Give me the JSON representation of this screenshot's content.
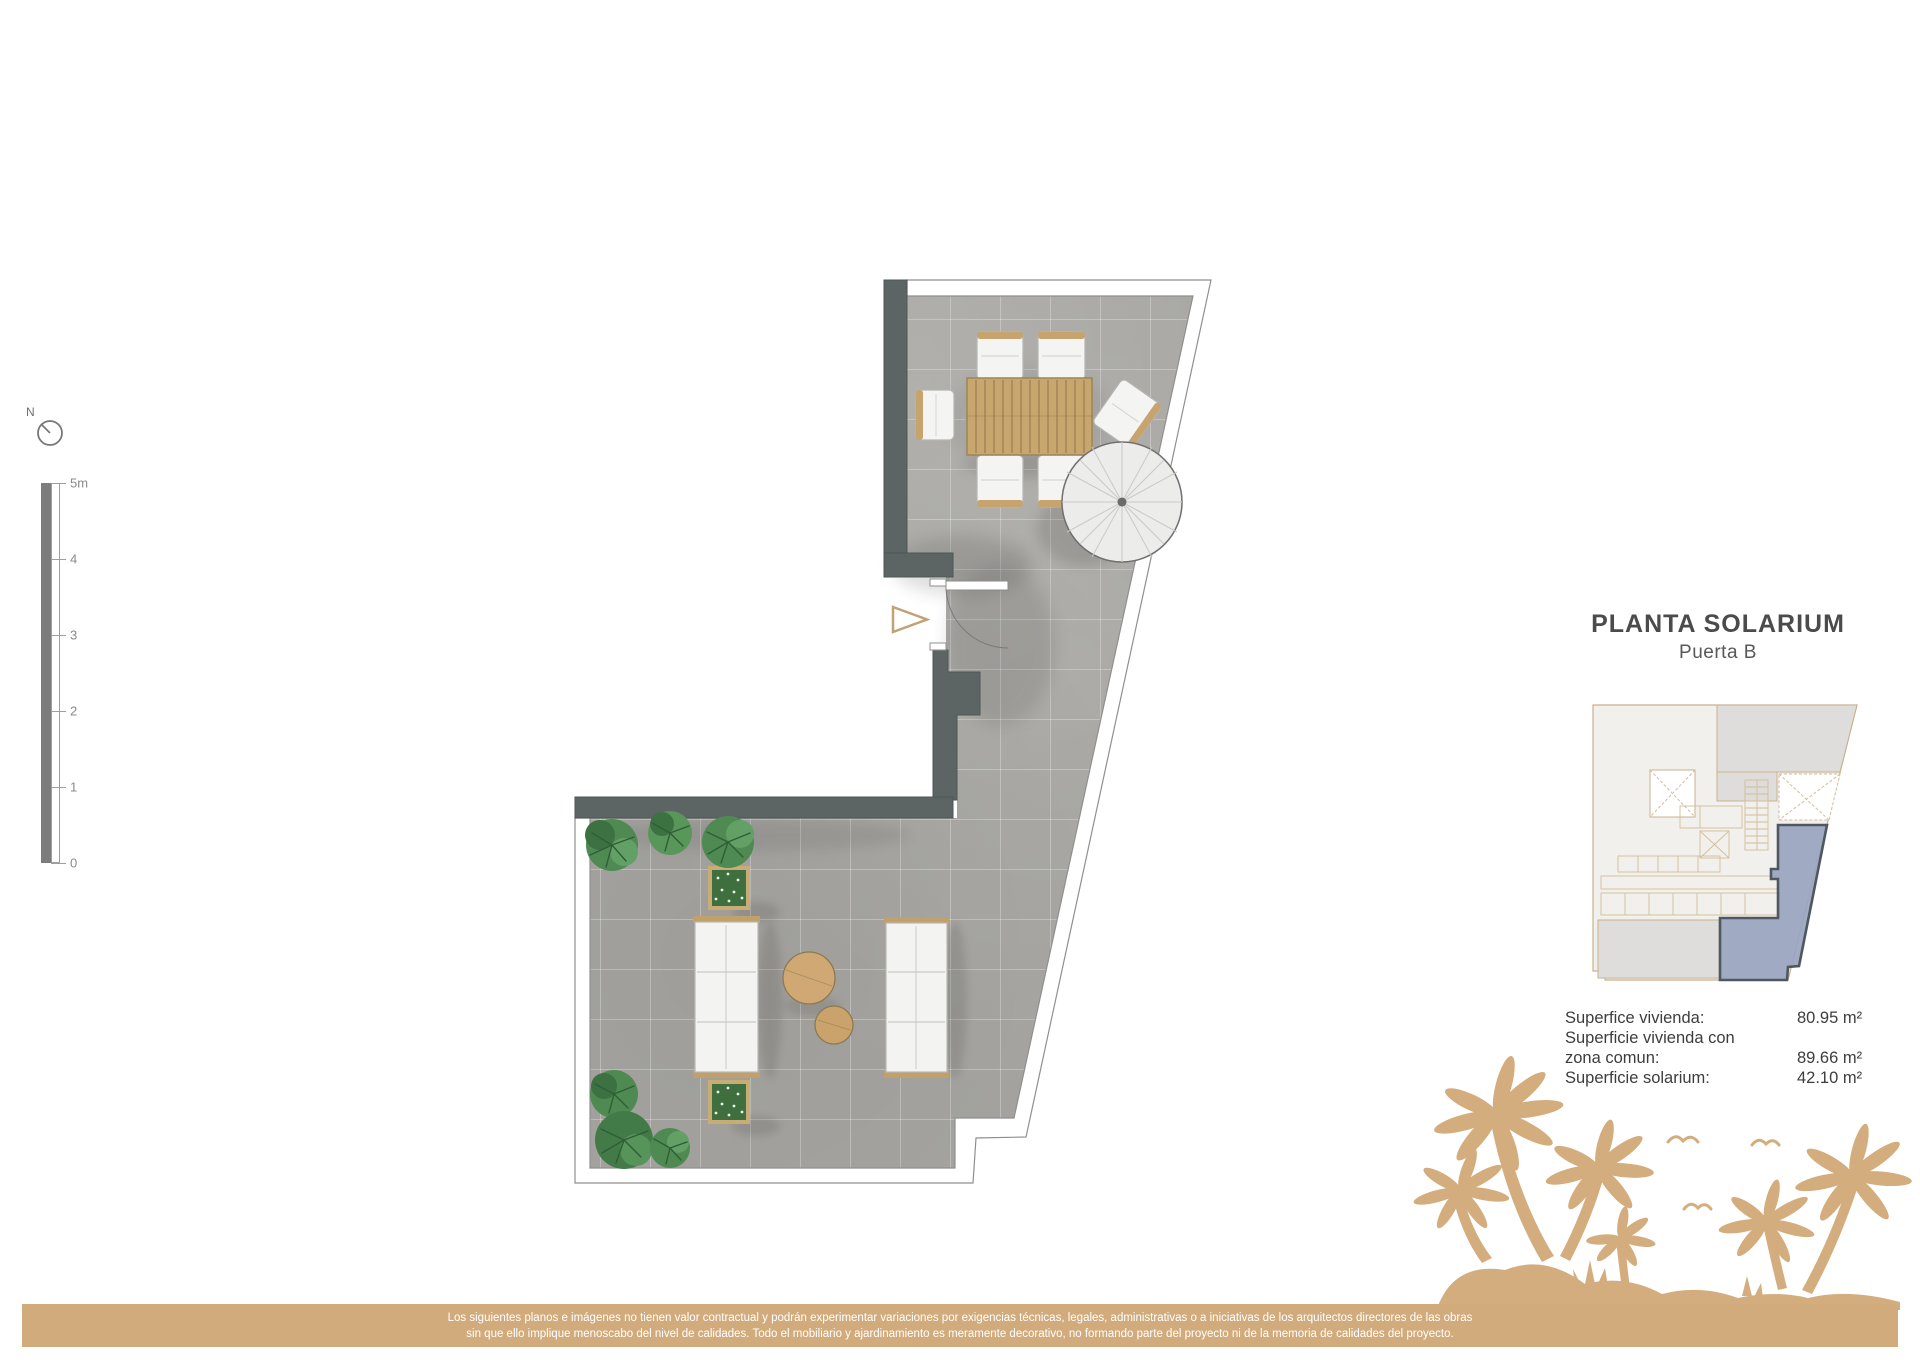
{
  "compass": {
    "label": "N"
  },
  "scale_bar": {
    "labels": [
      "5m",
      "4",
      "3",
      "2",
      "1",
      "0"
    ]
  },
  "title_block": {
    "title": "PLANTA SOLARIUM",
    "subtitle": "Puerta B"
  },
  "areas": {
    "rows": [
      {
        "label": "Superfice vivienda:",
        "value": "80.95 m²"
      },
      {
        "label": "Superficie vivienda con",
        "value": ""
      },
      {
        "label": "zona comun:",
        "value": "89.66 m²"
      },
      {
        "label": "Superficie solarium:",
        "value": "42.10 m²"
      }
    ]
  },
  "disclaimer": {
    "line1": "Los siguientes planos e imágenes no tienen valor contractual y podrán experimentar variaciones por exigencias técnicas, legales, administrativas o a iniciativas de los arquitectos directores de las obras",
    "line2": "sin que ello implique menoscabo del nivel de calidades. Todo el mobiliario y ajardinamiento es meramente decorativo, no formando parte del proyecto ni de la memoria de calidades del proyecto."
  },
  "colors": {
    "wall": "#5c6564",
    "tile": "#a7a6a2",
    "furniture_tan": "#c7a46e",
    "deco_tan": "#d4ad7e",
    "keyplan_highlight": "#9aa4bf",
    "keyplan_outline": "#c9b18e"
  }
}
